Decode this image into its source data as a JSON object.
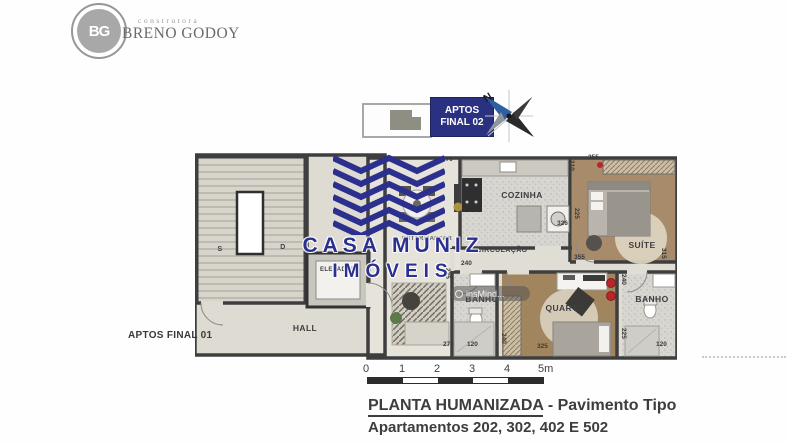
{
  "header": {
    "logo_monogram": "BG",
    "brand_small": "construtora",
    "brand_name": "BRENO GODOY"
  },
  "legend": {
    "badge_line1": "APTOS",
    "badge_line2": "FINAL 02",
    "compass_n": "N"
  },
  "plan": {
    "side_label": "APTOS FINAL 01",
    "rooms": {
      "hall": "HALL",
      "elevador": "ELEVADOR",
      "stair_s": "S",
      "stair_d": "D",
      "estar": "ESTAR/JANTAR",
      "cozinha": "COZINHA",
      "circulacao": "CIRCULAÇÃO",
      "banho1": "BANHO",
      "quarto": "QUARTO",
      "suite": "SUÍTE",
      "banho2": "BANHO"
    },
    "measurements": {
      "coz_top": "270",
      "coz_right": "210",
      "suite_top": "255",
      "suite_left": "225",
      "coz_machine": "326",
      "suite_bottom": "355",
      "suite_right": "315",
      "circ_width": "240",
      "banho1_left": "225",
      "hall_bottom": "270",
      "banho1_bottom": "120",
      "quarto_left": "240",
      "quarto_bottom": "325",
      "banho2_top": "240",
      "banho2_left": "225",
      "banho2_bottom": "120"
    }
  },
  "watermarks": {
    "brand_line1": "CASA MUNIZ",
    "brand_line2": "IMÓVEIS",
    "photo_tool": "insMind..."
  },
  "scalebar": {
    "ticks": [
      "0",
      "1",
      "2",
      "3",
      "4",
      "5m"
    ]
  },
  "footer": {
    "title_strong": "PLANTA HUMANIZADA",
    "title_rest": " - Pavimento Tipo",
    "subtitle": "Apartamentos 202, 302, 402 E 502"
  },
  "colors": {
    "watermark_blue": "#2b2f8e",
    "badge_navy": "#2a3180",
    "wall": "#3e3e3e",
    "wood_floor": "#a78b6b",
    "light_floor": "#e2dfd7",
    "tile_floor": "#d8d6d0",
    "accent_red": "#b8252a",
    "title_text": "#3d3d3d"
  }
}
